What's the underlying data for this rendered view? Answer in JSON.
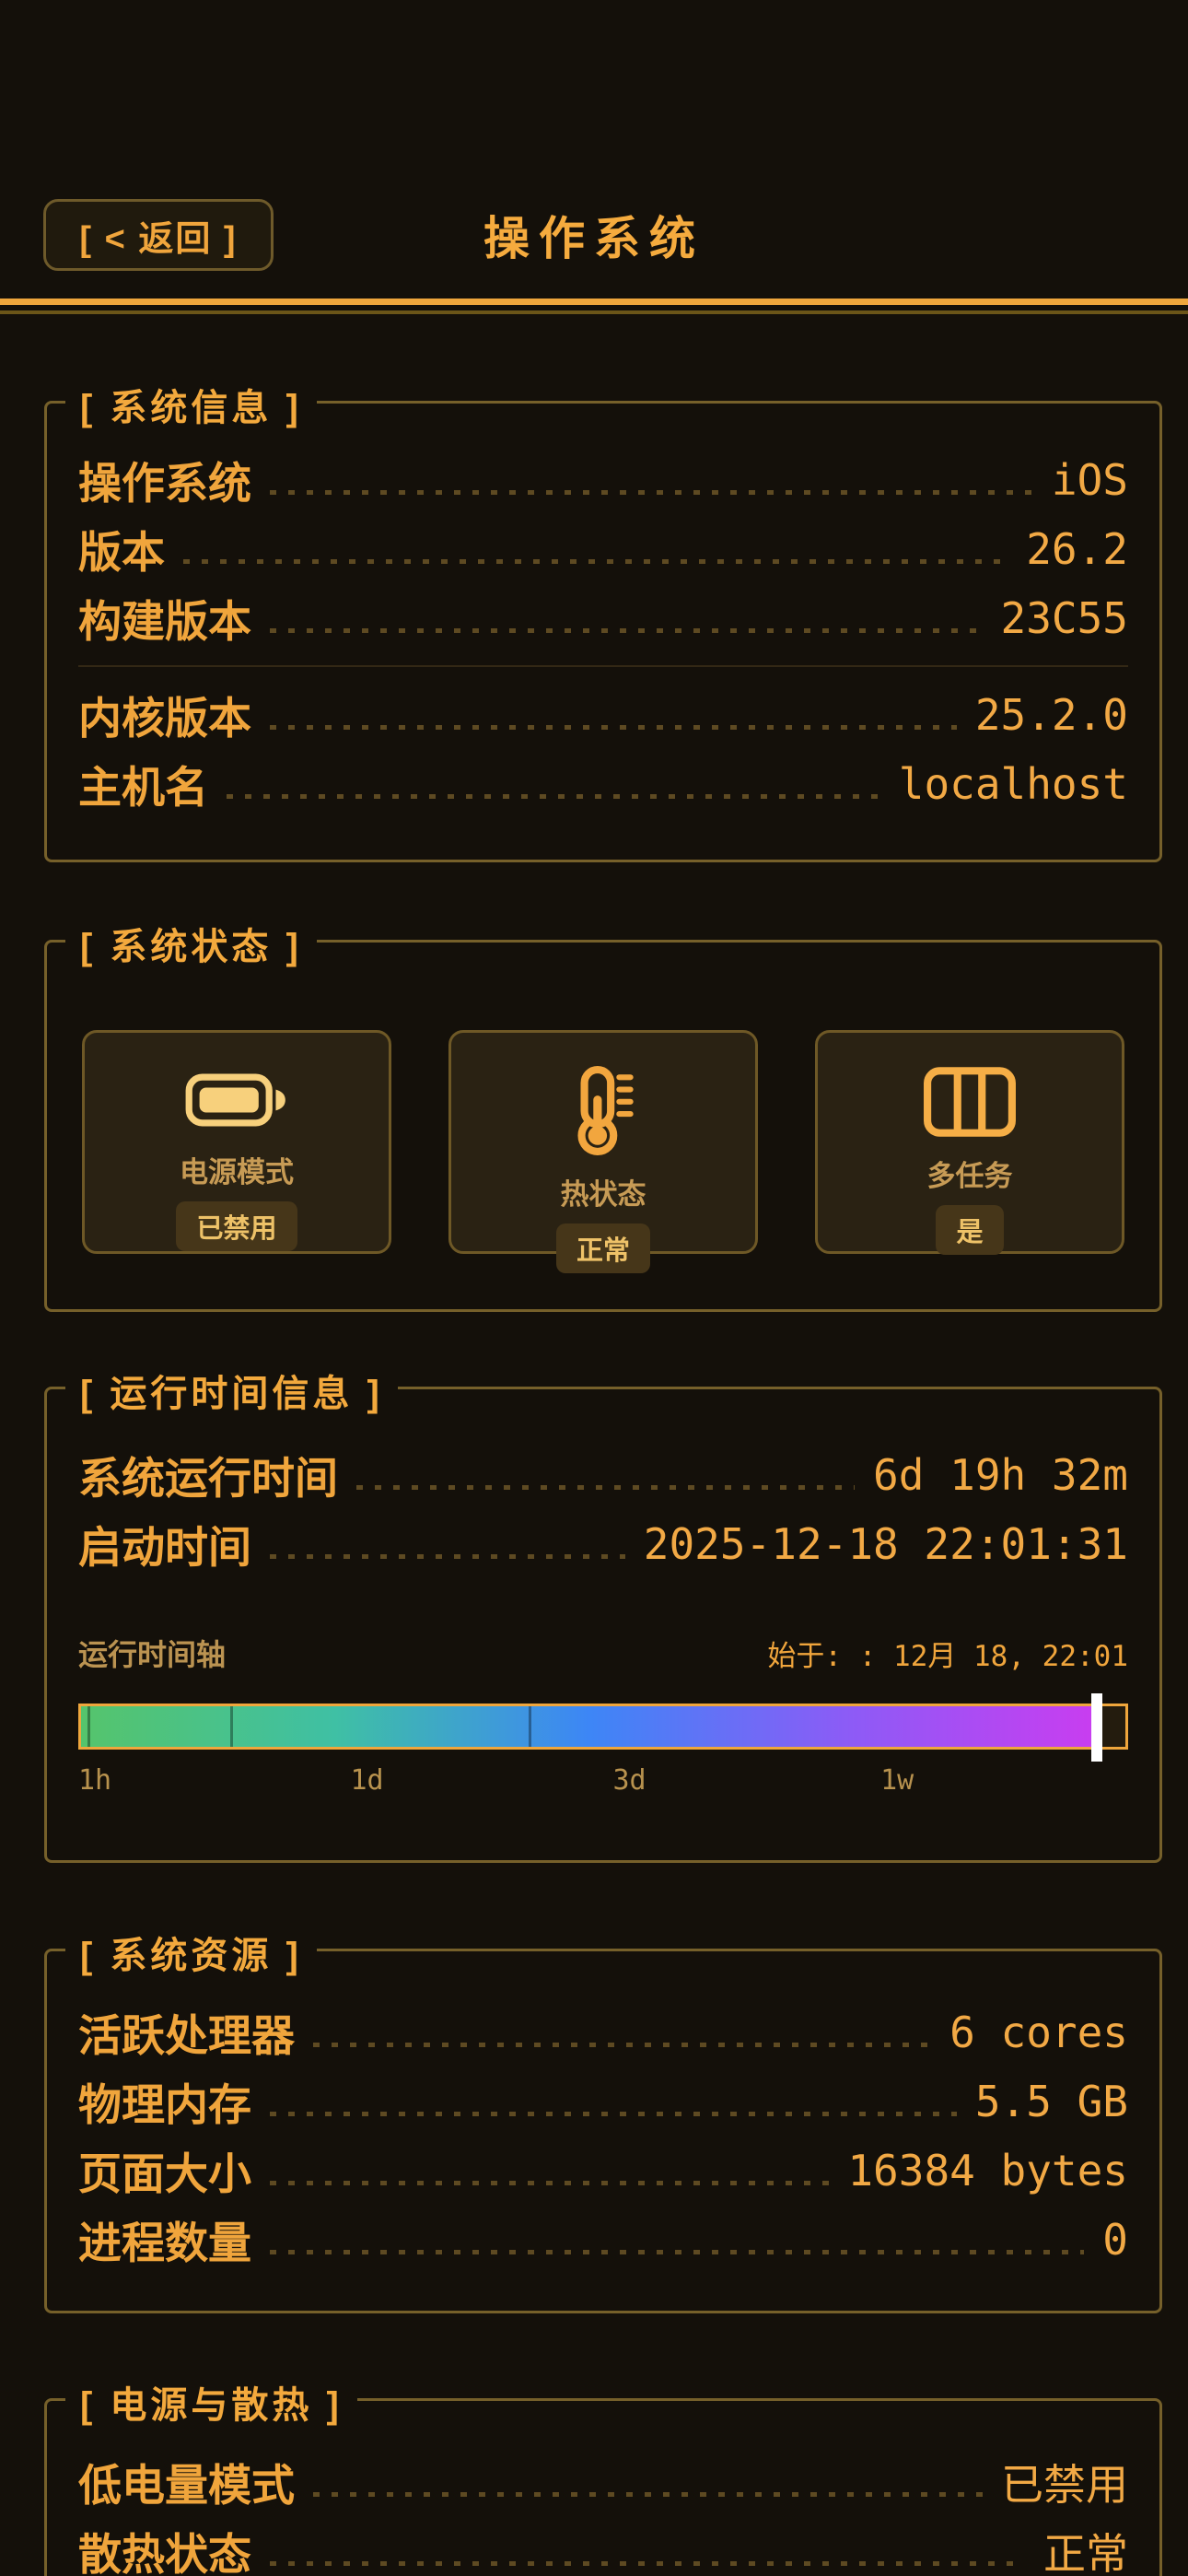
{
  "header": {
    "back_label": "[ < 返回 ]",
    "title": "操作系统"
  },
  "colors": {
    "page_bg": "#14100a",
    "accent": "#f0a53c",
    "accent_bright": "#f7d07c",
    "muted_label": "#bb9351",
    "leader_dots": "#5e4a22",
    "section_border": "#76602a",
    "card_bg": "#2a2213",
    "card_border": "#6e5826",
    "badge_bg": "#463619",
    "badge_text": "#eec268",
    "marker": "#ffffff"
  },
  "sections": {
    "system_info": {
      "legend": "[ 系统信息 ]",
      "rows_top": [
        {
          "label": "操作系统",
          "value": "iOS"
        },
        {
          "label": "版本",
          "value": "26.2"
        },
        {
          "label": "构建版本",
          "value": "23C55"
        }
      ],
      "rows_bottom": [
        {
          "label": "内核版本",
          "value": "25.2.0"
        },
        {
          "label": "主机名",
          "value": "localhost"
        }
      ]
    },
    "system_status": {
      "legend": "[ 系统状态 ]",
      "cards": [
        {
          "icon": "battery-icon",
          "label": "电源模式",
          "badge": "已禁用"
        },
        {
          "icon": "thermometer-icon",
          "label": "热状态",
          "badge": "正常"
        },
        {
          "icon": "multitask-columns-icon",
          "label": "多任务",
          "badge": "是"
        }
      ]
    },
    "uptime_info": {
      "legend": "[ 运行时间信息 ]",
      "rows": [
        {
          "label": "系统运行时间",
          "value": "6d 19h 32m"
        },
        {
          "label": "启动时间",
          "value": "2025-12-18 22:01:31"
        }
      ],
      "timeline": {
        "axis_label": "运行时间轴",
        "start_label": "始于: : 12月 18, 22:01",
        "progress_percent": 97.3,
        "gradient": [
          "#55c46c",
          "#3fc0a4",
          "#3d86f6",
          "#8b5cf6",
          "#c93df0"
        ],
        "tick_marks_percent": [
          0.6,
          14.3,
          42.9
        ],
        "tick_labels": [
          {
            "text": "1h",
            "percent": 0,
            "align": "left"
          },
          {
            "text": "1d",
            "percent": 27.5,
            "align": "center"
          },
          {
            "text": "3d",
            "percent": 52.5,
            "align": "center"
          },
          {
            "text": "1w",
            "percent": 78,
            "align": "center"
          }
        ]
      }
    },
    "system_resources": {
      "legend": "[ 系统资源 ]",
      "rows": [
        {
          "label": "活跃处理器",
          "value": "6 cores"
        },
        {
          "label": "物理内存",
          "value": "5.5 GB"
        },
        {
          "label": "页面大小",
          "value": "16384 bytes"
        },
        {
          "label": "进程数量",
          "value": "0"
        }
      ]
    },
    "power_thermal": {
      "legend": "[ 电源与散热 ]",
      "rows": [
        {
          "label": "低电量模式",
          "value": "已禁用"
        },
        {
          "label": "散热状态",
          "value": "正常"
        }
      ]
    }
  }
}
